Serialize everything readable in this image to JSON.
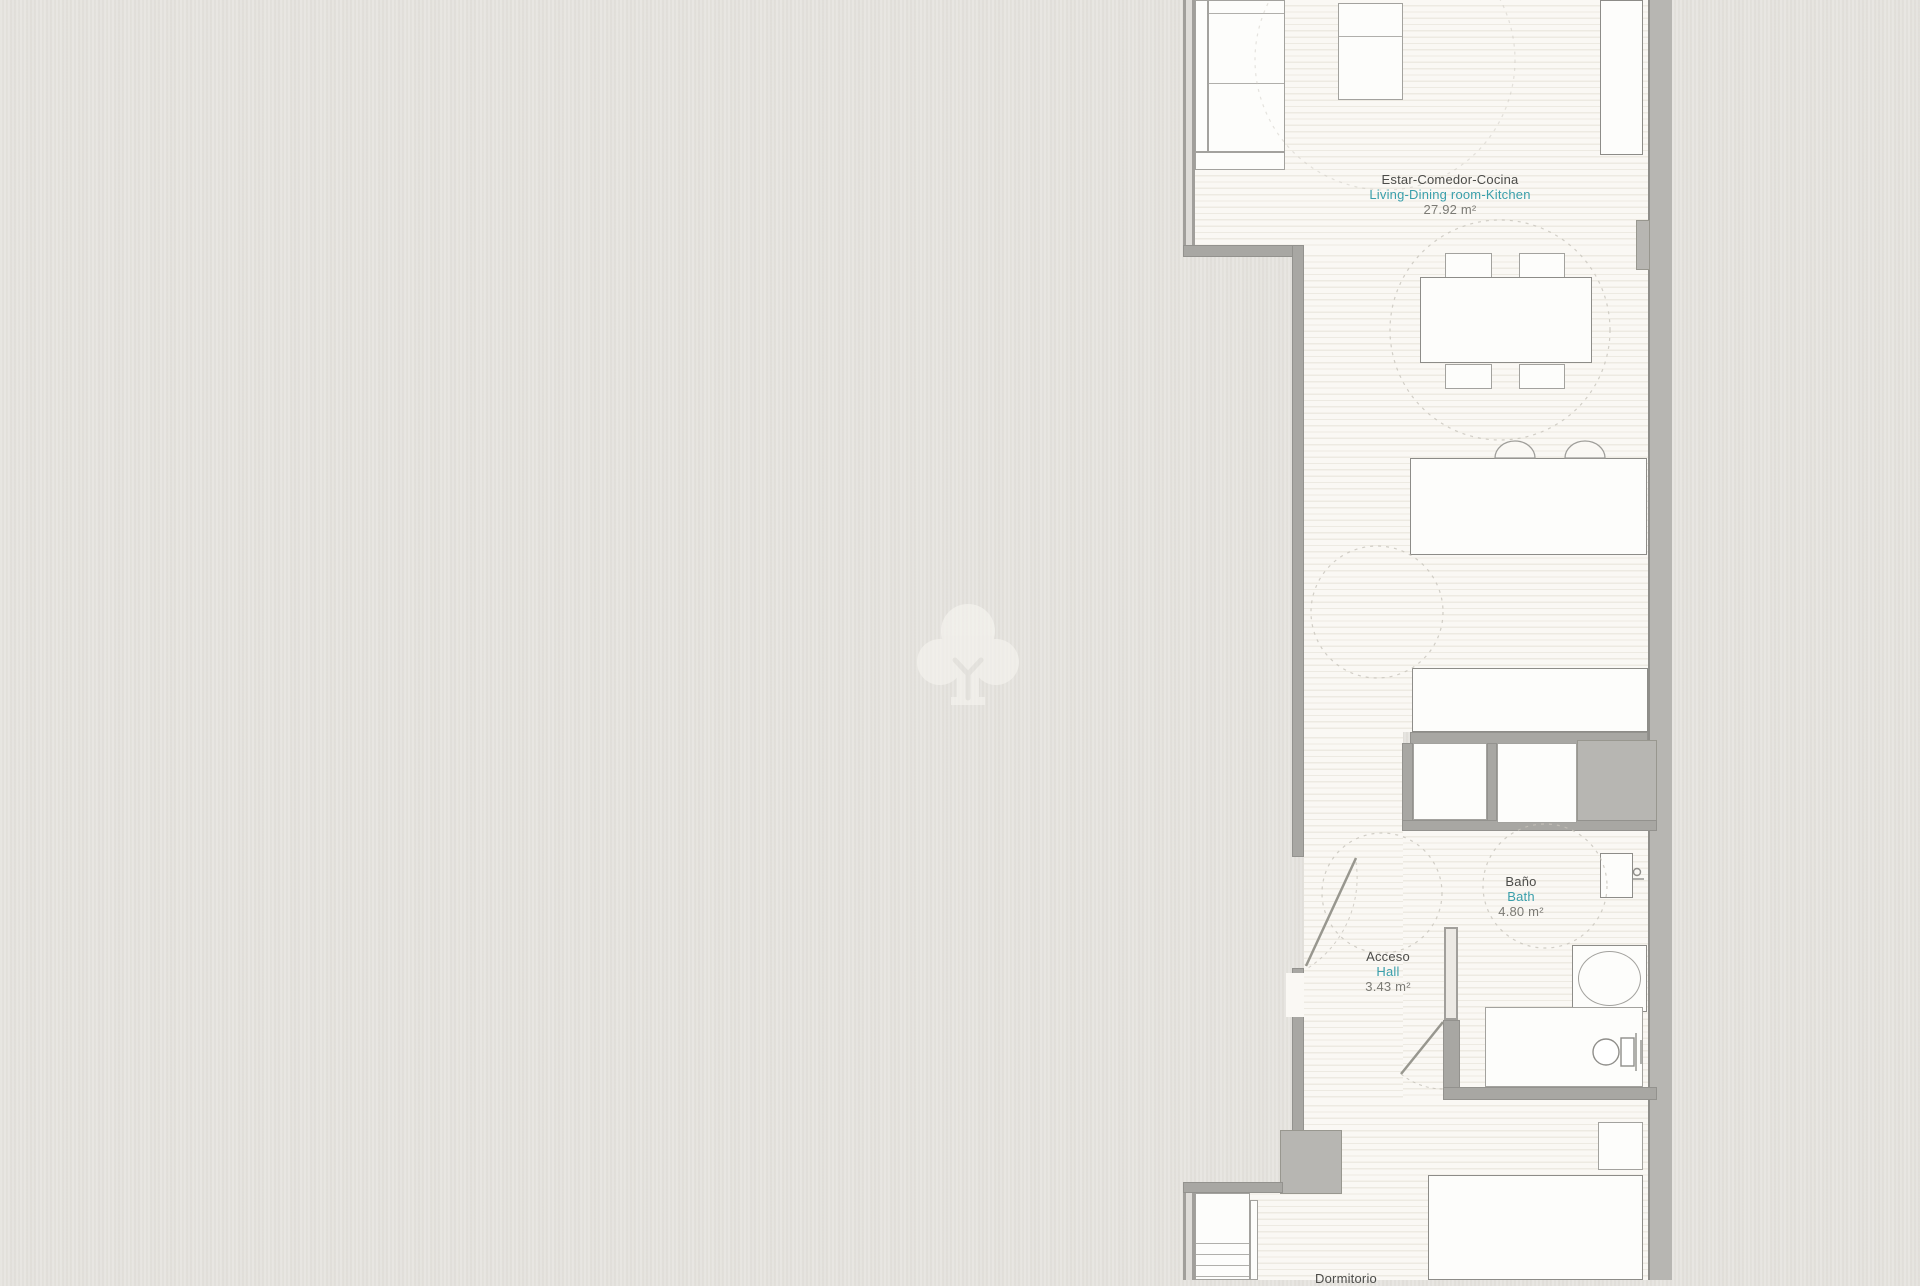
{
  "watermark": {
    "icon": "tree-logo"
  },
  "rooms": {
    "living": {
      "es": "Estar-Comedor-Cocina",
      "en": "Living-Dining room-Kitchen",
      "area": "27.92 m²"
    },
    "bath": {
      "es": "Baño",
      "en": "Bath",
      "area": "4.80 m²"
    },
    "hall": {
      "es": "Acceso",
      "en": "Hall",
      "area": "3.43 m²"
    },
    "bedroom": {
      "es": "Dormitorio"
    }
  },
  "colors": {
    "canvas": "#e4e2dd",
    "floor": "#faf8f4",
    "wall": "#a8a7a3",
    "label_text": "#4c4c49",
    "label_accent": "#3a9fab",
    "label_area": "#7b7a74"
  }
}
